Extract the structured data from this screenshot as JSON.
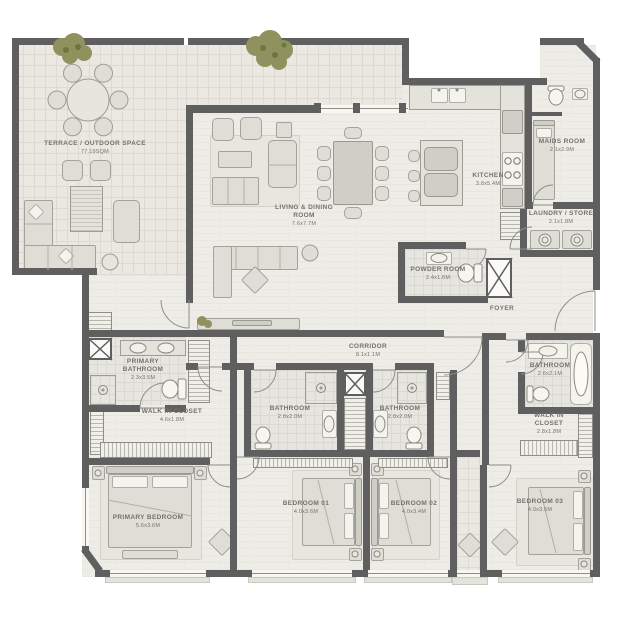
{
  "plan_title": "3 bedroom + maids apartment floor plan",
  "palette": {
    "wall": "#5f5f5f",
    "floor": "#edece6",
    "terrace_tile": "#eae8e1",
    "furniture": "#deddd6",
    "furniture_border": "#a3a29b",
    "label_text": "#73736c",
    "greenery": "#8f925f",
    "window": "#f7f6f1"
  },
  "rooms": [
    {
      "id": "terrace",
      "name": "TERRACE / OUTDOOR SPACE",
      "dims": "77.19SQM"
    },
    {
      "id": "living",
      "name": "LIVING & DINING ROOM",
      "dims": "7.6x7.7M"
    },
    {
      "id": "kitchen",
      "name": "KITCHEN",
      "dims": "3.8x5.4M"
    },
    {
      "id": "maids",
      "name": "MAIDS ROOM",
      "dims": "2.1x2.9M"
    },
    {
      "id": "laundry",
      "name": "LAUNDRY / STORE",
      "dims": "2.1x1.8M"
    },
    {
      "id": "powder",
      "name": "POWDER ROOM",
      "dims": "2.4x1.6M"
    },
    {
      "id": "foyer",
      "name": "FOYER",
      "dims": ""
    },
    {
      "id": "corridor",
      "name": "CORRIDOR",
      "dims": "8.1x1.1M"
    },
    {
      "id": "primary-bath",
      "name": "PRIMARY BATHROOM",
      "dims": "2.3x3.5M"
    },
    {
      "id": "walkin-1",
      "name": "WALK IN CLOSET",
      "dims": "4.6x1.8M"
    },
    {
      "id": "primary-bed",
      "name": "PRIMARY BEDROOM",
      "dims": "5.6x3.6M"
    },
    {
      "id": "bath-1",
      "name": "BATHROOM",
      "dims": "2.8x2.0M"
    },
    {
      "id": "bath-2",
      "name": "BATHROOM",
      "dims": "2.8x2.0M"
    },
    {
      "id": "bedroom-01",
      "name": "BEDROOM 01",
      "dims": "4.0x3.6M"
    },
    {
      "id": "bedroom-02",
      "name": "BEDROOM 02",
      "dims": "4.0x3.4M"
    },
    {
      "id": "bedroom-03",
      "name": "BEDROOM 03",
      "dims": "4.0x3.5M"
    },
    {
      "id": "bath-3",
      "name": "BATHROOM",
      "dims": "2.6x2.1M"
    },
    {
      "id": "walkin-3",
      "name": "WALK IN CLOSET",
      "dims": "2.8x1.8M"
    }
  ]
}
